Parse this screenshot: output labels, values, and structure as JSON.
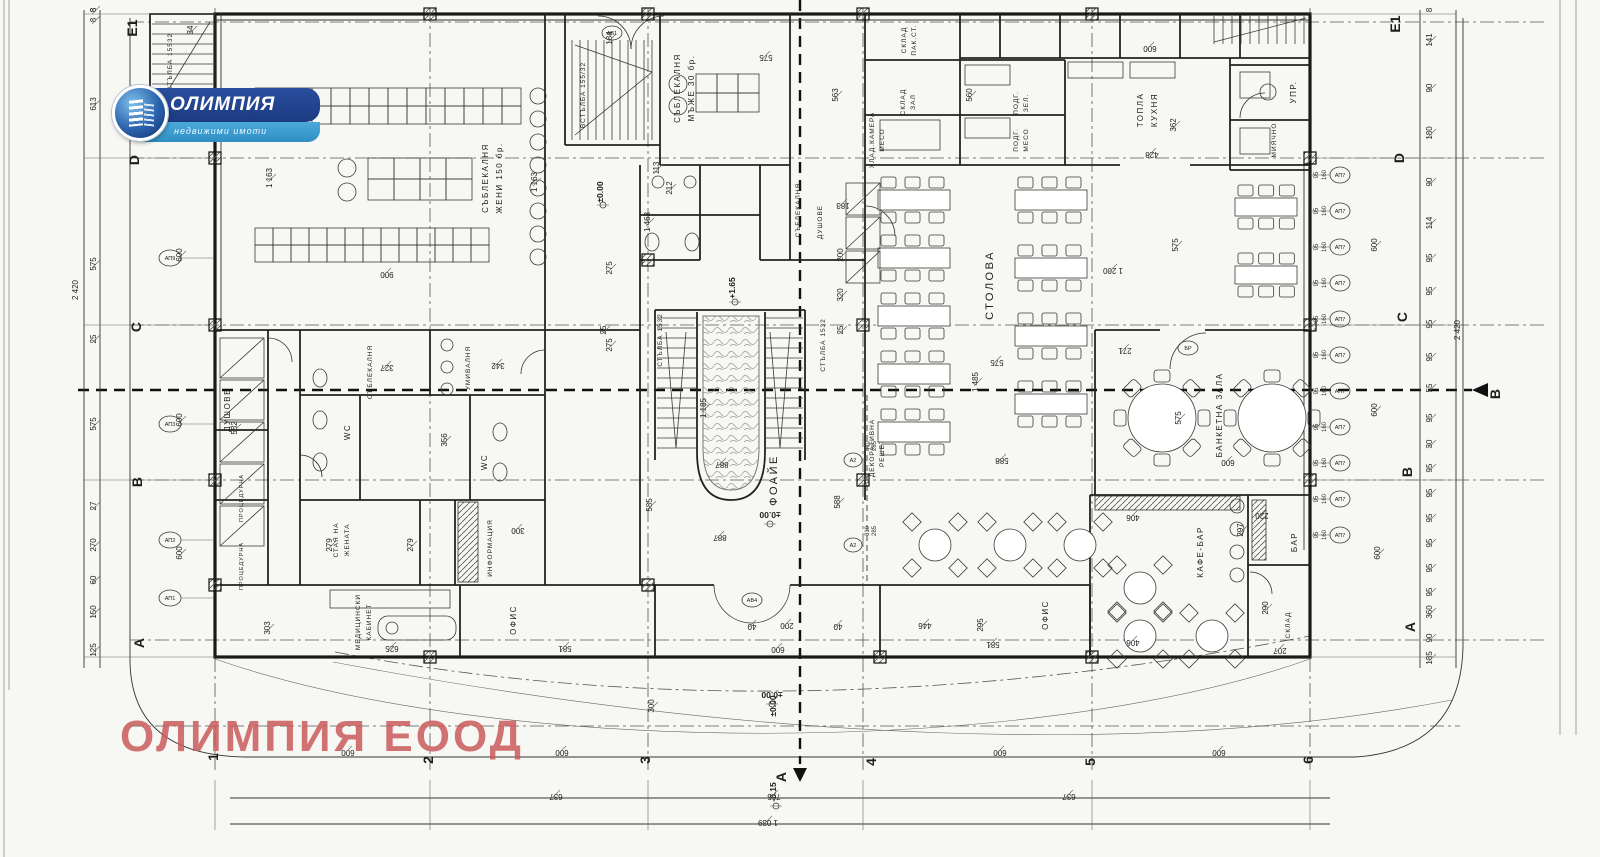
{
  "logo": {
    "brand": "ОЛИМПИЯ",
    "tagline": "недвижими имоти"
  },
  "watermark": "ОЛИМПИЯ ЕООД",
  "grid": {
    "left": [
      "Е1",
      "D",
      "C",
      "В",
      "А"
    ],
    "right": [
      "Е1",
      "D",
      "C",
      "В",
      "А"
    ],
    "bottom": [
      "1",
      "2",
      "3",
      "4",
      "5",
      "6"
    ]
  },
  "sections": {
    "a": "А",
    "b": "В"
  },
  "elevations": {
    "zero": "±0.00",
    "up": "+1.65",
    "down": "-0.15"
  },
  "stairs": {
    "tl": "СТЪЛБА 15532",
    "top": "ВСТЪЛБА 155/32",
    "central": "СТЪЛБА 1532"
  },
  "rooms": {
    "locker_women_1": "СЪБЛЕКАЛНЯ",
    "locker_women_2": "ЖЕНИ 150 бр.",
    "locker_men_1": "СЪБЛЕКАЛНЯ",
    "locker_men_2": "МЪЖЕ 30 бр.",
    "sklad_pak_1": "СКЛАД",
    "sklad_pak_2": "ПАК.СТ.",
    "sklad_zal_1": "СКЛАД",
    "sklad_zal_2": "ЗАЛ",
    "kamera_1": "ХЛАД.КАМЕРА",
    "kamera_2": "МЕСО",
    "podg_zel_1": "ПОДГ.",
    "podg_zel_2": "ЗЕЛ.",
    "podg_meso_1": "ПОДГ.",
    "podg_meso_2": "МЕСО",
    "kitchen_1": "ТОПЛА",
    "kitchen_2": "КУХНЯ",
    "upr": "УПР.",
    "miyachno": "МИЯЧНО",
    "stolova": "СТОЛОВА",
    "banketna": "БАНКЕТНА ЗАЛА",
    "dekor_1": "ДЕКОРАТИВНА",
    "dekor_2": "РЕШЕТКА",
    "foaie": "ФОАЙЕ",
    "dushove": "ДУШОВЕ",
    "sublekalnya": "СЪБЛЕКАЛНЯ",
    "umivalnya": "УМИВАЛНЯ",
    "wc": "WC",
    "staya_1": "СТАЯ НА",
    "staya_2": "ЖЕНАТА",
    "informaciya": "ИНФОРМАЦИЯ",
    "procedurna": "ПРОЦЕДУРНА",
    "med_1": "МЕДИЦИНСКИ",
    "med_2": "КАБИНЕТ",
    "ofis": "ОФИС",
    "kafe_bar": "КАФЕ-БАР",
    "bar": "БАР",
    "sklad": "СКЛАД"
  },
  "dims": {
    "total": "2 420",
    "left": [
      "8",
      "8",
      "613",
      "575",
      "25",
      "575",
      "27",
      "270",
      "60",
      "150",
      "125"
    ],
    "right": [
      "141",
      "90",
      "180",
      "90",
      "114",
      "95",
      "95",
      "95",
      "95",
      "55",
      "95",
      "30",
      "95",
      "95",
      "95",
      "95",
      "95",
      "95",
      "360",
      "90",
      "185"
    ],
    "bottom": [
      "637",
      "765",
      "1 039",
      "637"
    ],
    "top8": "8",
    "inner": [
      "900",
      "275",
      "275",
      "1 163",
      "1 163",
      "1 463",
      "563",
      "575",
      "560",
      "600",
      "362",
      "428",
      "1 200",
      "575",
      "1 485",
      "575",
      "588",
      "271",
      "575",
      "600",
      "1 185",
      "887",
      "887",
      "585",
      "588",
      "342",
      "327",
      "582",
      "356",
      "300",
      "279",
      "279",
      "303",
      "625",
      "581",
      "581",
      "446",
      "295",
      "406",
      "406",
      "297",
      "220",
      "290",
      "207",
      "300",
      "200",
      "40",
      "40",
      "600",
      "600",
      "600",
      "600",
      "600",
      "600",
      "600",
      "600",
      "600",
      "600",
      "600",
      "184",
      "212",
      "113",
      "183",
      "25",
      "25",
      "320",
      "200",
      "34"
    ]
  },
  "callouts": {
    "window": "АП7",
    "w1": "95",
    "w2": "160",
    "left": [
      "АП9",
      "АП3",
      "АП2",
      "АП1"
    ],
    "door": "А2",
    "d1": "310",
    "d2": "285",
    "entry": "АВ1",
    "entry2": "АВ4",
    "banq": "БР"
  }
}
